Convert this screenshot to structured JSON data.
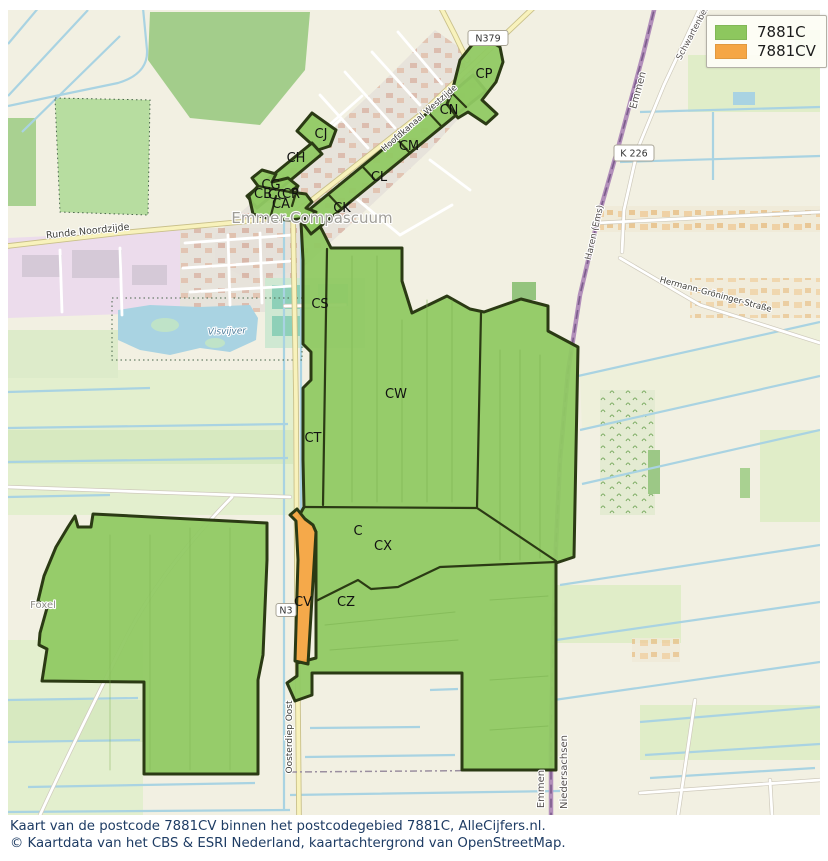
{
  "legend": {
    "items": [
      {
        "label": "7881C",
        "color": "#8dc75e"
      },
      {
        "label": "7881CV",
        "color": "#f5a645"
      }
    ]
  },
  "caption": {
    "line1": "Kaart van de postcode 7881CV binnen het postcodegebied 7881C, AlleCijfers.nl.",
    "line2": "© Kaartdata van het CBS & ESRI Nederland, kaartachtergrond van OpenStreetMap."
  },
  "colors": {
    "area_7881c": "#8dc75e",
    "area_7881cv": "#f5a645",
    "area_outline": "#2b3a14",
    "water": "#a9d3e2",
    "boundary_road": "#b28fba",
    "caption_text": "#1e3c64"
  },
  "map": {
    "town_label": "Emmer-Compascuum",
    "area_labels": [
      {
        "text": "CP",
        "x": 484,
        "y": 78
      },
      {
        "text": "CN",
        "x": 449,
        "y": 114
      },
      {
        "text": "CM",
        "x": 409,
        "y": 150
      },
      {
        "text": "CL",
        "x": 379,
        "y": 181
      },
      {
        "text": "CK",
        "x": 342,
        "y": 212
      },
      {
        "text": "CJ",
        "x": 321,
        "y": 138
      },
      {
        "text": "CH",
        "x": 296,
        "y": 162
      },
      {
        "text": "CG",
        "x": 271,
        "y": 189
      },
      {
        "text": "CB",
        "x": 263,
        "y": 198
      },
      {
        "text": "CC",
        "x": 277,
        "y": 199
      },
      {
        "text": "CR",
        "x": 291,
        "y": 198
      },
      {
        "text": "CA",
        "x": 281,
        "y": 208
      },
      {
        "text": "CS",
        "x": 320,
        "y": 308
      },
      {
        "text": "CW",
        "x": 396,
        "y": 398
      },
      {
        "text": "CT",
        "x": 313,
        "y": 442
      },
      {
        "text": "C",
        "x": 358,
        "y": 535
      },
      {
        "text": "CX",
        "x": 383,
        "y": 550
      },
      {
        "text": "CV",
        "x": 303,
        "y": 606
      },
      {
        "text": "CZ",
        "x": 346,
        "y": 606
      }
    ],
    "road_labels": [
      {
        "text": "Emmer-Compascuum",
        "x": 312,
        "y": 223,
        "size": 15,
        "color": "#9f9d97",
        "rot": 0,
        "halo": true
      },
      {
        "text": "Runde Noordzijde",
        "x": 88,
        "y": 234,
        "size": 9.5,
        "color": "#3e3e38",
        "rot": -6,
        "halo": true
      },
      {
        "text": "Hoofdkanaal Westzijde",
        "x": 421,
        "y": 120,
        "size": 8.5,
        "color": "#3e3e38",
        "rot": -41,
        "halo": true
      },
      {
        "text": "Emmen",
        "x": 641,
        "y": 91,
        "size": 10,
        "color": "#56514f",
        "rot": -75,
        "halo": true
      },
      {
        "text": "Schwartenberg",
        "x": 696,
        "y": 32,
        "size": 8.5,
        "color": "#56514f",
        "rot": -62,
        "halo": true
      },
      {
        "text": "Haren (Ems)",
        "x": 597,
        "y": 233,
        "size": 9,
        "color": "#56514f",
        "rot": -77,
        "halo": true
      },
      {
        "text": "Hermann-Gröninger-Straße",
        "x": 715,
        "y": 297,
        "size": 8.5,
        "color": "#3e3e38",
        "rot": 15,
        "halo": true
      },
      {
        "text": "Visvijver",
        "x": 227,
        "y": 334,
        "size": 9,
        "color": "#4e7f9e",
        "rot": -2,
        "italic": true,
        "halo": true
      },
      {
        "text": "Foxel",
        "x": 43,
        "y": 608,
        "size": 10,
        "color": "#8d8b85",
        "rot": 0,
        "halo": true
      },
      {
        "text": "Oosterdiep Oost",
        "x": 292,
        "y": 737,
        "size": 9,
        "color": "#3e3e38",
        "rot": -90,
        "halo": true
      },
      {
        "text": "Emmen",
        "x": 544,
        "y": 789,
        "size": 10,
        "color": "#56514f",
        "rot": -90,
        "halo": true
      },
      {
        "text": "Niedersachsen",
        "x": 567,
        "y": 772,
        "size": 10,
        "color": "#56514f",
        "rot": -90,
        "halo": true
      }
    ],
    "road_badges": [
      {
        "text": "N379",
        "x": 488,
        "y": 38,
        "w": 40,
        "h": 15
      },
      {
        "text": "K 226",
        "x": 634,
        "y": 153,
        "w": 40,
        "h": 16
      },
      {
        "text": "N3",
        "x": 286,
        "y": 610,
        "w": 20,
        "h": 13
      }
    ]
  }
}
